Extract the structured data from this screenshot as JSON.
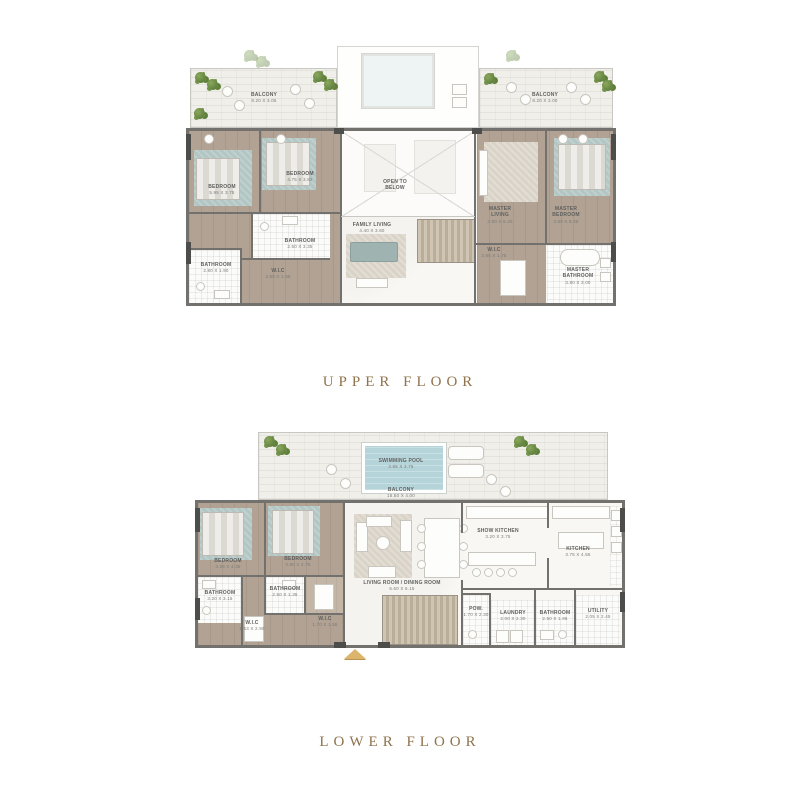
{
  "titles": {
    "upper": "UPPER FLOOR",
    "lower": "LOWER FLOOR"
  },
  "colors": {
    "title_gold": "#8e734c",
    "wall_gray": "#73716d",
    "wood_floor": "#b1a293",
    "rug_teal": "#b2c6c4",
    "pool_blue": "#b5d4da",
    "plant_green": "#5e8038",
    "balcony_stone": "#f1efe9",
    "entrance_arrow_gold": "#dcb46b"
  },
  "upper": {
    "rooms": {
      "balcony_left": {
        "name": "BALCONY",
        "dim": "8.20 X 3.05"
      },
      "balcony_right": {
        "name": "BALCONY",
        "dim": "8.20 X 3.00"
      },
      "bedroom1": {
        "name": "BEDROOM",
        "dim": "5.95 X 3.75"
      },
      "bedroom2": {
        "name": "BEDROOM",
        "dim": "4.75 X 3.82"
      },
      "bathroom_center": {
        "name": "BATHROOM",
        "dim": "2.50 X 3.35"
      },
      "bathroom_left": {
        "name": "BATHROOM",
        "dim": "2.80 X 1.90"
      },
      "wic1": {
        "name": "W.I.C",
        "dim": "3.60 X 1.85"
      },
      "open_to_below": {
        "name": "OPEN TO BELOW"
      },
      "family_living": {
        "name": "FAMILY LIVING",
        "dim": "4.40 X 3.60"
      },
      "master_living": {
        "name": "MASTER LIVING",
        "dim": "3.80 X 5.40"
      },
      "master_bedroom": {
        "name": "MASTER BEDROOM",
        "dim": "3.80 X 5.45"
      },
      "wic2": {
        "name": "W.I.C",
        "dim": "3.85 X 1.75"
      },
      "master_bathroom": {
        "name": "MASTER BATHROOM",
        "dim": "3.80 X 3.00"
      }
    }
  },
  "lower": {
    "rooms": {
      "swimming_pool": {
        "name": "SWIMMING POOL",
        "dim": "3.85 X 3.75"
      },
      "balcony": {
        "name": "BALCONY",
        "dim": "15.50 X 4.00"
      },
      "bedroom3": {
        "name": "BEDROOM",
        "dim": "3.35 X 4.35"
      },
      "bedroom4": {
        "name": "BEDROOM",
        "dim": "3.60 X 4.75"
      },
      "bathroom3": {
        "name": "BATHROOM",
        "dim": "3.20 X 3.15"
      },
      "bathroom4": {
        "name": "BATHROOM",
        "dim": "2.50 X 1.35"
      },
      "wic3": {
        "name": "W.I.C",
        "dim": "1.70 X 1.55"
      },
      "wic4": {
        "name": "W.I.C",
        "dim": "1.63 X 2.90"
      },
      "living_dining": {
        "name": "LIVING ROOM / DINING ROOM",
        "dim": "6.60 X 6.15"
      },
      "show_kitchen": {
        "name": "SHOW KITCHEN",
        "dim": "3.20 X 3.75"
      },
      "kitchen": {
        "name": "KITCHEN",
        "dim": "3.75 X 4.55"
      },
      "powder": {
        "name": "POW.",
        "dim": "1.70 X 2.30"
      },
      "laundry": {
        "name": "LAUNDRY",
        "dim": "2.00 X 2.30"
      },
      "bathroom5": {
        "name": "BATHROOM",
        "dim": "2.50 X 1.95"
      },
      "utility": {
        "name": "UTILITY",
        "dim": "2.05 X 2.45"
      }
    }
  }
}
